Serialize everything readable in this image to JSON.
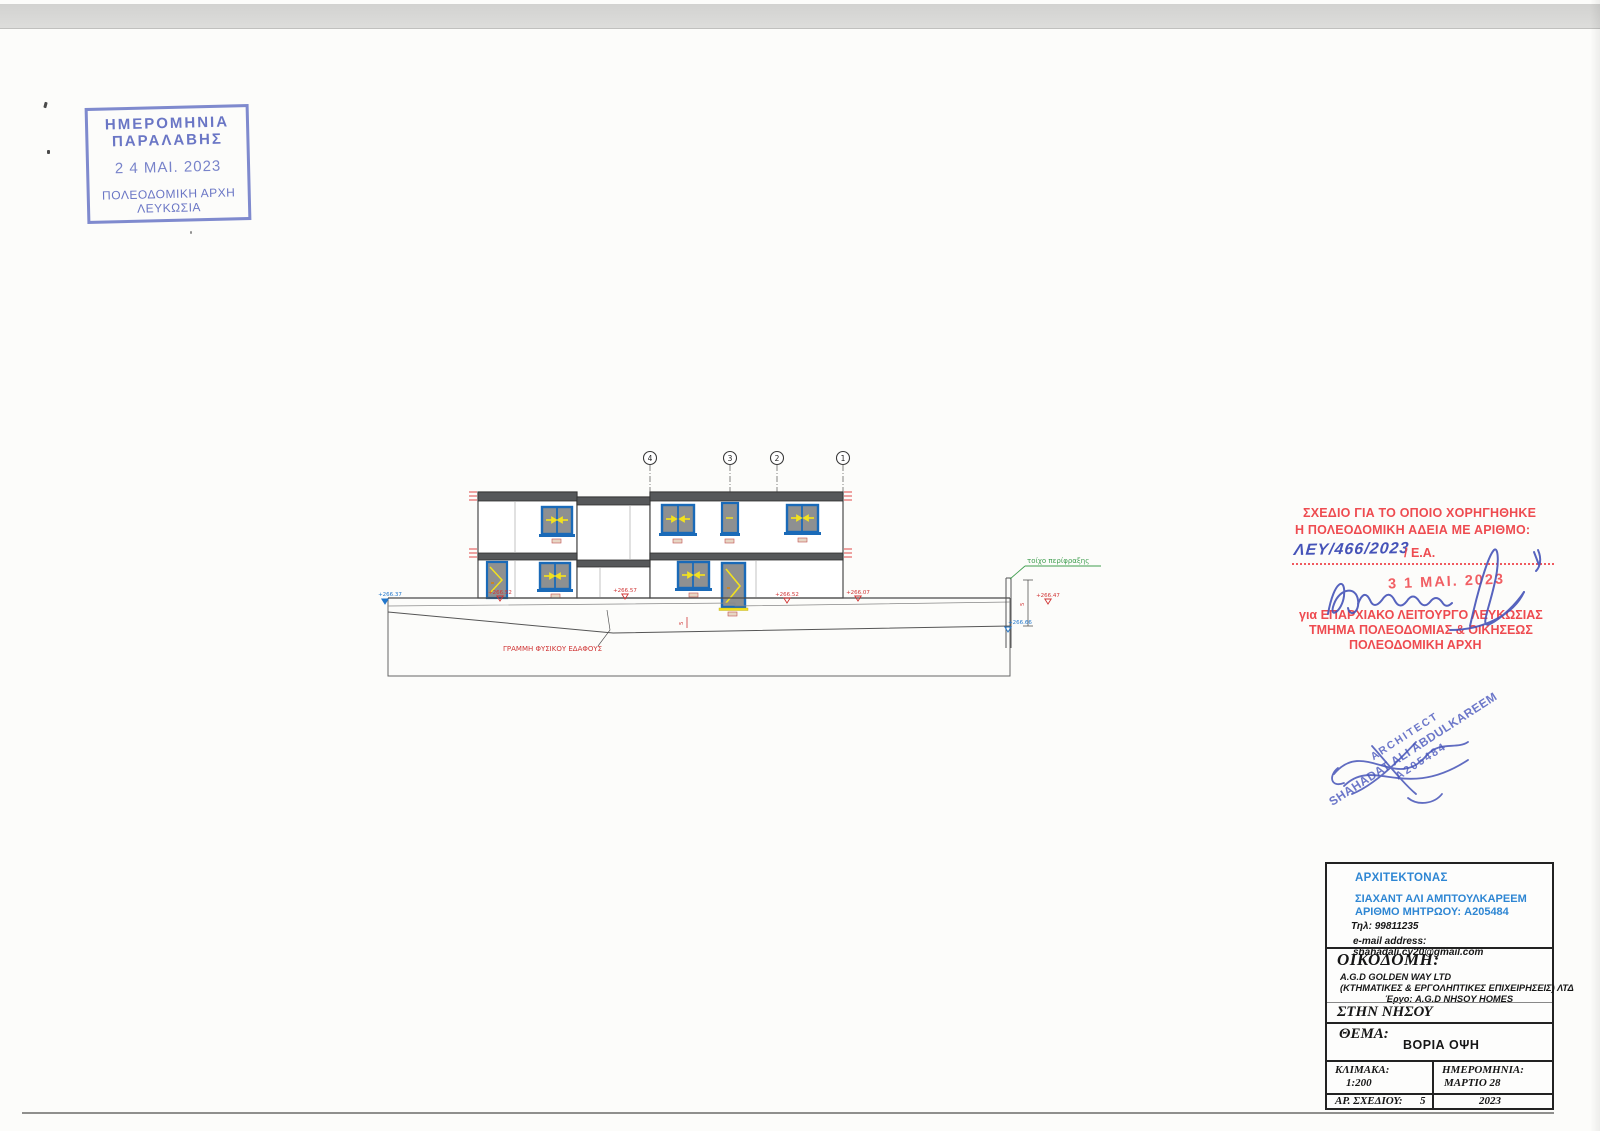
{
  "receipt_stamp": {
    "line1": "ΗΜΕΡΟΜΗΝΙΑ",
    "line2": "ΠΑΡΑΛΑΒΗΣ",
    "date": "2 4 ΜΑΙ. 2023",
    "line3": "ΠΟΛΕΟΔΟΜΙΚΗ ΑΡΧΗ",
    "line4": "ΛΕΥΚΩΣΙΑ",
    "color": "#6a76c5"
  },
  "drawing": {
    "grid_bubbles": [
      "4",
      "3",
      "2",
      "1"
    ],
    "ground_line_label": "ΓΡΑΜΜΗ ΦΥΣΙΚΟΥ ΕΔΑΦΟΥΣ",
    "fence_label": "τοίχο περίφραξης",
    "levels_red": [
      "+266.52",
      "+266.57",
      "+266.52",
      "+266.07",
      "+266.47"
    ],
    "levels_blue": [
      "+266.37",
      "+266.66"
    ],
    "dim_value": "5",
    "colors": {
      "window_frame": "#1a6ab8",
      "glass": "#8e9091",
      "arrow_yellow": "#f2e11e",
      "slab_gray": "#56585a",
      "annotation_red": "#d03535",
      "annotation_green": "#3f9e4f",
      "annotation_blue": "#2277cc"
    }
  },
  "permit_stamp": {
    "line1": "ΣΧΕΔΙΟ ΓΙΑ ΤΟ ΟΠΟΙΟ ΧΟΡΗΓΗΘΗΚΕ",
    "line2": "Η ΠΟΛΕΟΔΟΜΙΚΗ ΑΔΕΙΑ ΜΕ ΑΡΙΘΜΟ:",
    "permit_number": "ΛΕΥ/466/2023",
    "ea_label": "/ Ε.Α.",
    "date_stamp": "3 1 ΜΑΙ. 2023",
    "line3": "για ΕΠΑΡΧΙΑΚΟ ΛΕΙΤΟΥΡΓΟ ΛΕΥΚΩΣΙΑΣ",
    "line4": "ΤΜΗΜΑ ΠΟΛΕΟΔΟΜΙΑΣ & ΟΙΚΗΣΕΩΣ",
    "line5": "ΠΟΛΕΟΔΟΜΙΚΗ ΑΡΧΗ",
    "color": "#ee4b50",
    "ink_color": "#4553b8"
  },
  "architect_stamp": {
    "line1": "ARCHITECT",
    "line2": "SHAHADAT ALI ABDULKAREEM",
    "line3": "A205484",
    "color": "#5864c2"
  },
  "title_block": {
    "architect_heading": "ΑΡΧΙΤΕΚΤΟΝΑΣ",
    "architect_name": "ΣΙΑΧΑΝΤ ΑΛΙ ΑΜΠΤΟΥΛΚΑΡΕΕΜ",
    "registry": "ΑΡΙΘΜΟ ΜΗΤΡΩΟΥ: A205484",
    "phone": "Τηλ: 99811235",
    "email": "e-mail address: shahadali.cy20@gmail.com",
    "building_heading": "ΟΙΚΟΔΟΜΗ:",
    "company1": "A.G.D GOLDEN WAY LTD",
    "company2": "(ΚΤΗΜΑΤΙΚΕΣ & ΕΡΓΟΛΗΠΤΙΚΕΣ ΕΠΙΧΕΙΡΗΣΕΙΣ) ΛΤΔ",
    "project": "Έργο: A.G.D NHSOY HOMES",
    "location": "ΣΤΗΝ ΝΗΣΟΥ",
    "subject_label": "ΘΕΜΑ:",
    "subject_value": "ΒΟΡΙΑ ΟΨΗ",
    "scale_label": "ΚΛΙΜΑΚΑ:",
    "scale_value": "1:200",
    "date_label": "ΗΜΕΡΟΜΗΝΙΑ:",
    "date_value": "ΜΑΡΤΙΟ 28",
    "sheet_label": "ΑΡ. ΣΧΕΔΙΟΥ:",
    "sheet_value": "5",
    "year": "2023"
  }
}
